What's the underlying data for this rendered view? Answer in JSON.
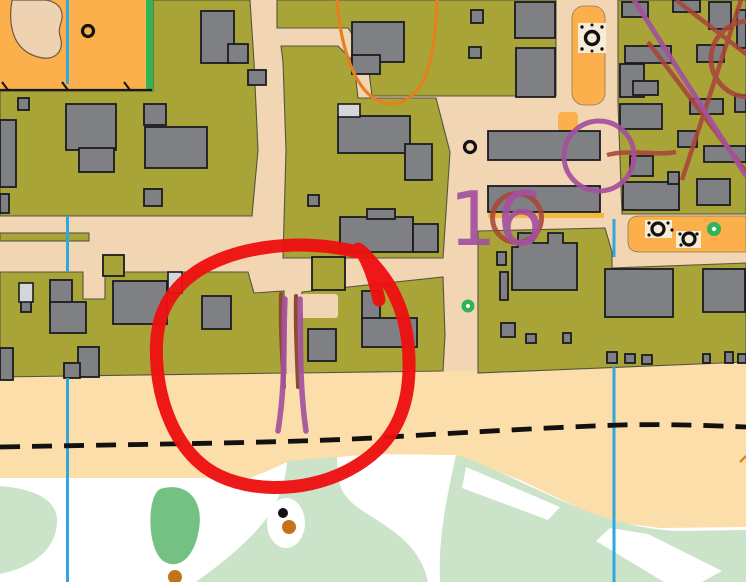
{
  "map": {
    "type": "orienteering-sprint-map",
    "annotations": {
      "control_number": "16"
    },
    "colors": {
      "residential_olive": "#A8A437",
      "road_tan": "#F2D6B4",
      "beach_sand": "#FBDEA9",
      "open_orange": "#FBB04B",
      "rough_open_white": "#FFFFFF",
      "vegetation_pale_green": "#CBE4C9",
      "vegetation_mid_green": "#74C183",
      "tree_green": "#2FB457",
      "building_gray": "#7E8084",
      "canopy_light_gray": "#D5D6D8",
      "outline_dark": "#1B1B20",
      "block_edge": "#55553F",
      "north_line_blue": "#2FA8DF",
      "course_purple": "#A4519E",
      "other_course_dark_red": "#A8453A",
      "contour_orange": "#E5801F",
      "gully_brown": "#8C4B2F",
      "annotation_red": "#ED1111",
      "path_black": "#111111",
      "knoll_brown_dot": "#C4731B",
      "sand_patch_beige": "#F6ECD8",
      "yellow_strip": "#F5B942"
    }
  }
}
